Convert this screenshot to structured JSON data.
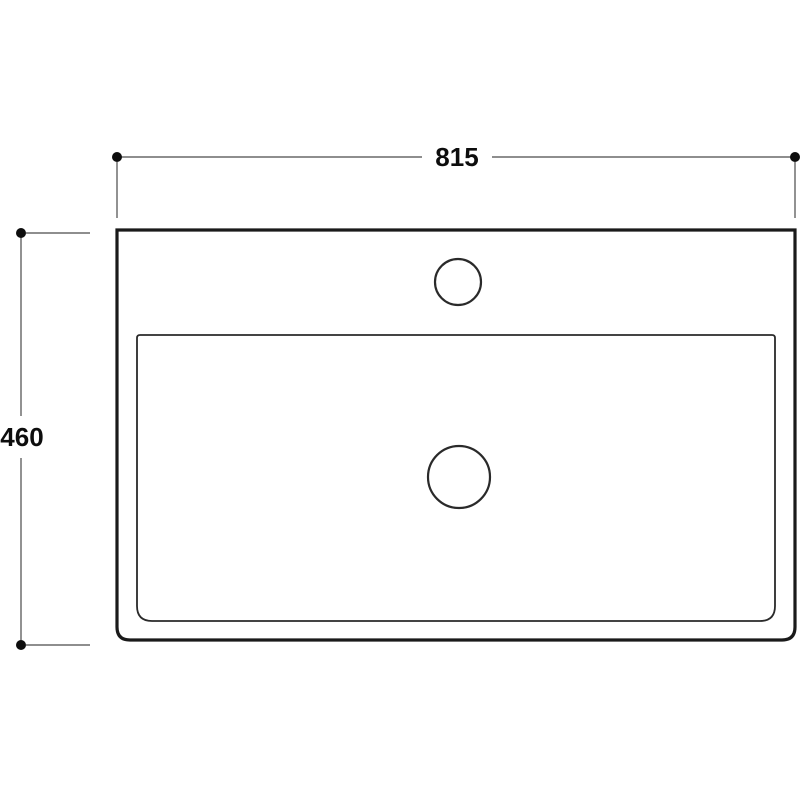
{
  "page": {
    "background": "#ffffff"
  },
  "drawing": {
    "type": "technical-drawing-top-view",
    "line_color": "#1a1a1a",
    "bowl_line_color": "#2a2a2a",
    "dimension_line_color": "#4a4a4a",
    "dimension_text_color": "#0d0d0d",
    "dimensions": {
      "width": {
        "label": "815"
      },
      "depth": {
        "label": "460"
      }
    }
  }
}
